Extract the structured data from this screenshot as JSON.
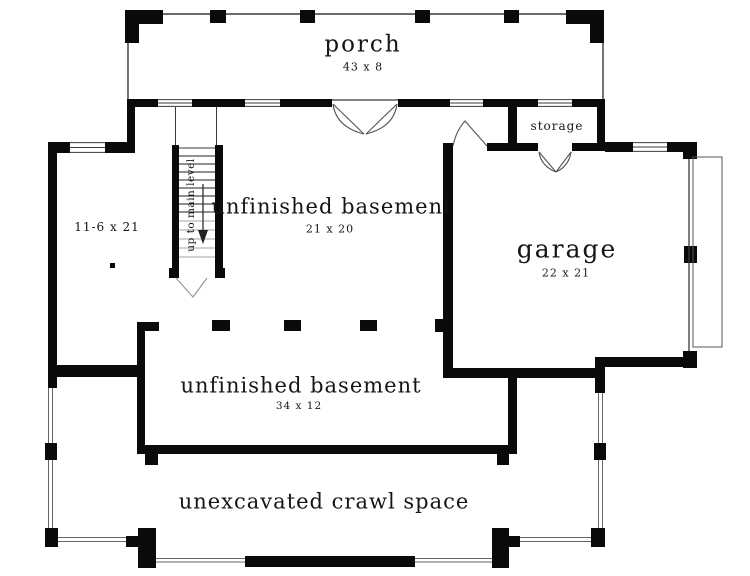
{
  "colors": {
    "wall": "#0a0a0a",
    "thin_line": "#3a3a3a",
    "door_line": "#555555",
    "text": "#151515",
    "background": "#ffffff"
  },
  "rooms": {
    "porch": {
      "name": "porch",
      "dims": "43 x 8"
    },
    "basement_upper": {
      "name": "unfinished basement",
      "dims": "21 x 20"
    },
    "garage": {
      "name": "garage",
      "dims": "22 x 21"
    },
    "storage": {
      "name": "storage"
    },
    "side_room": {
      "dims": "11-6 x 21"
    },
    "basement_lower": {
      "name": "unfinished basement",
      "dims": "34 x 12"
    },
    "crawl_space": {
      "name": "unexcavated crawl space"
    }
  },
  "stairs": {
    "direction_label": "up to main level"
  }
}
